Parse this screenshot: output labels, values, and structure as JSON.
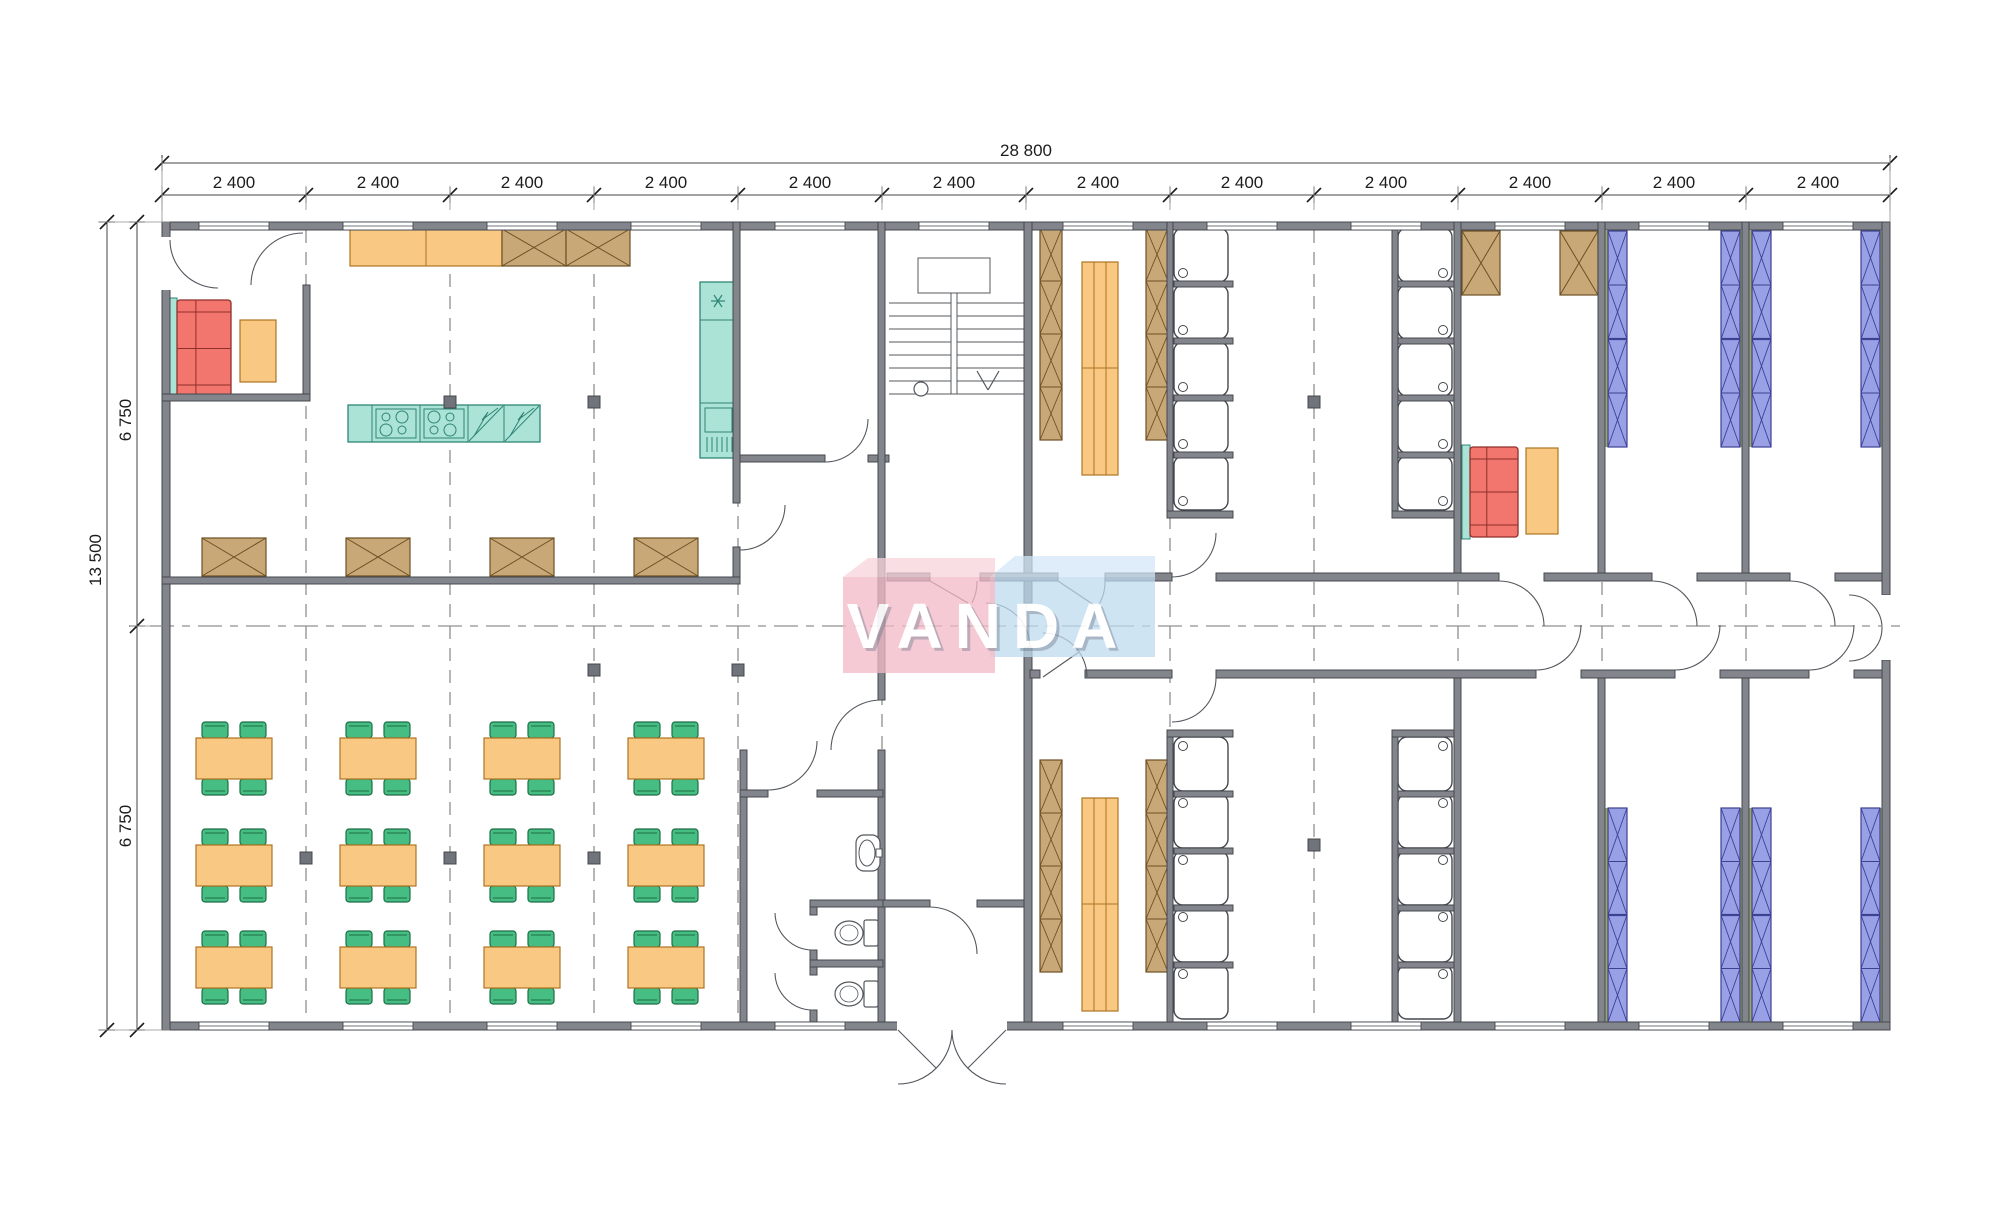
{
  "document": {
    "type": "architectural floor plan",
    "units": "mm"
  },
  "watermark": {
    "text": "VANDA"
  },
  "dimensions": {
    "top_total": "28 800",
    "top_segment": "2 400",
    "top_segment_count": 12,
    "side_total": "13 500",
    "side_half_upper": "6 750",
    "side_half_lower": "6 750"
  },
  "plan": {
    "grid_bays": 12,
    "dining_table_rows": 3,
    "dining_table_cols": 4,
    "chairs_per_table": 4,
    "shower_columns": 4,
    "showers_per_column": 5,
    "locker_strips": 4,
    "locker_cells_per_strip": 4,
    "bunk_strips": 8,
    "bunk_cells_per_strip": 4,
    "toilet_stalls": 2,
    "washbasins": 1,
    "sofas": 2,
    "cooktops": 2,
    "staircases": 1
  },
  "colors": {
    "wall": "#82868c",
    "wall_stroke": "#44484e",
    "line": "#54585e",
    "dim": "#1c1c1c",
    "dash": "#8f8f8f",
    "tan": "#c9a878",
    "tan_stroke": "#6e5026",
    "orange": "#f9c983",
    "orange_stroke": "#ad7423",
    "teal": "#abe3d6",
    "teal_stroke": "#2f8577",
    "red": "#f2766e",
    "red_stroke": "#8f2f2a",
    "green": "#46bd82",
    "green_stroke": "#1d6e46",
    "purple": "#9aa0e6",
    "purple_stroke": "#3c4193",
    "olive": "#9aa86a",
    "column": "#70747a",
    "wm_pink_front": "#f2bac6",
    "wm_pink_top": "#f8d3da",
    "wm_blue_front": "#bed9ed",
    "wm_blue_top": "#d2e6f6",
    "wm_text": "#ffffff"
  }
}
